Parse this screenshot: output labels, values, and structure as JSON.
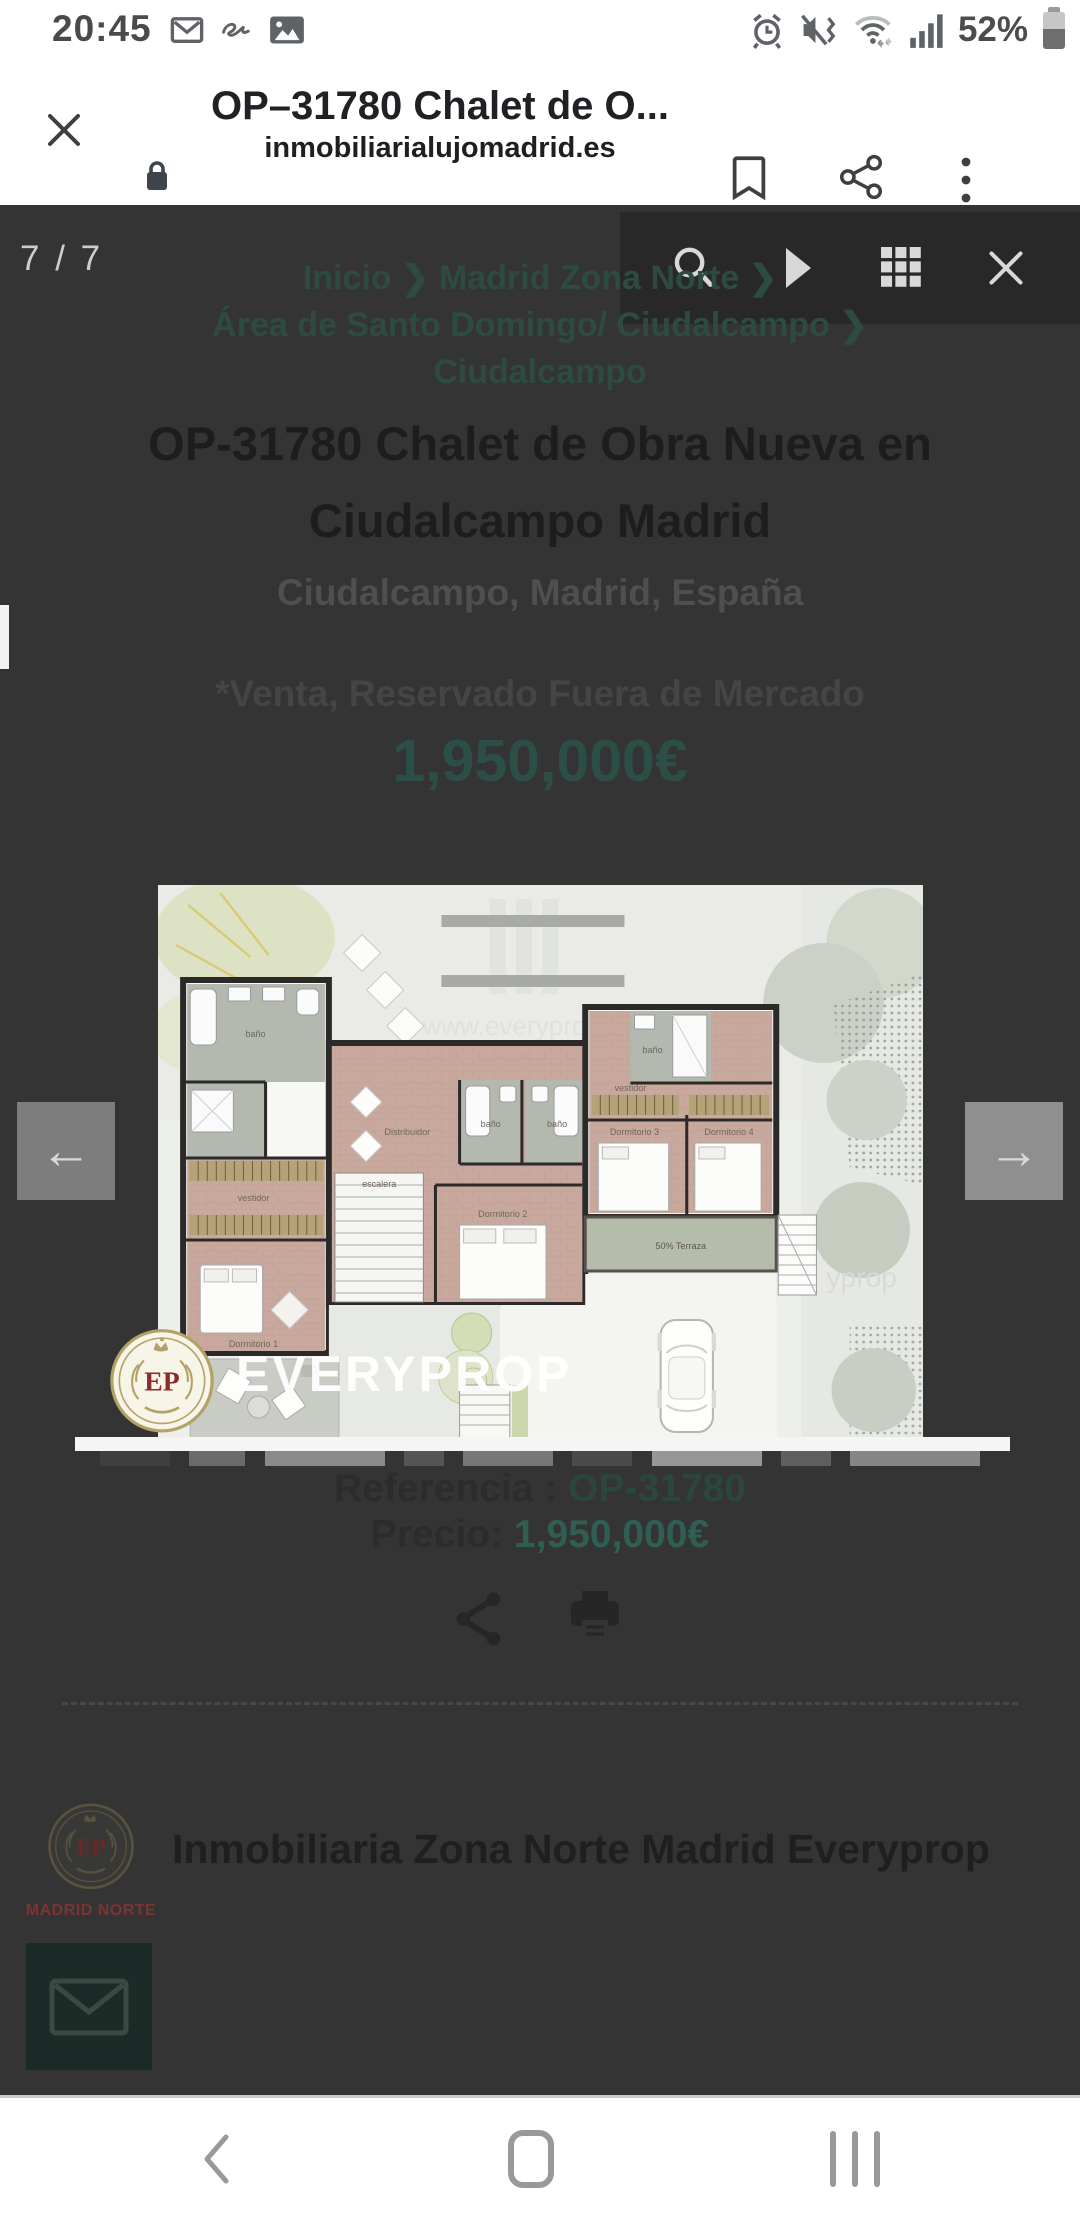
{
  "status_bar": {
    "time": "20:45",
    "battery_level": "52%"
  },
  "browser": {
    "page_title": "OP–31780 Chalet de O...",
    "url": "inmobiliarialujomadrid.es"
  },
  "lightbox": {
    "counter": "7 / 7",
    "arrow_left": "←",
    "arrow_right": "→"
  },
  "listing": {
    "breadcrumb_lines": [
      "Inicio ❯ Madrid Zona Norte ❯",
      "Área de Santo Domingo/ Ciudalcampo ❯",
      "Ciudalcampo"
    ],
    "title": "OP-31780 Chalet de Obra Nueva en Ciudalcampo Madrid",
    "location": "Ciudalcampo, Madrid, España",
    "availability": "*Venta, Reservado Fuera de Mercado",
    "price": "1,950,000€",
    "reference_label": "Referencia : ",
    "reference_value": "OP-31780",
    "price_label": "Precio: ",
    "price_value": "1,950,000€"
  },
  "agency": {
    "name": "Inmobiliaria Zona Norte Madrid Everyprop",
    "logo_initials": "EP",
    "logo_caption": "MADRID NORTE"
  },
  "watermark": {
    "brand": "EVERYPROP",
    "logo_initials": "EP"
  },
  "floorplan": {
    "room_labels": [
      "baño",
      "vestidor",
      "Dormitorio 1",
      "escalera",
      "Distribuidor",
      "baño",
      "baño",
      "Dormitorio 2",
      "Dormitorio 3",
      "Dormitorio 4",
      "baño",
      "vestidor",
      "50% Terraza"
    ],
    "watermark_text": "www.everyprop.com",
    "watermark_fragment": "yprop"
  },
  "colors": {
    "overlay_bg": "#343434",
    "toolbar_bg": "#282828",
    "teal_price": "#2b4f47",
    "teal_link": "#2b463f",
    "teal_price_value": "#2f5e53",
    "email_button_bg": "#1d2b28",
    "crest_gold": "#b3a268",
    "crest_red": "#8d2a2a"
  }
}
